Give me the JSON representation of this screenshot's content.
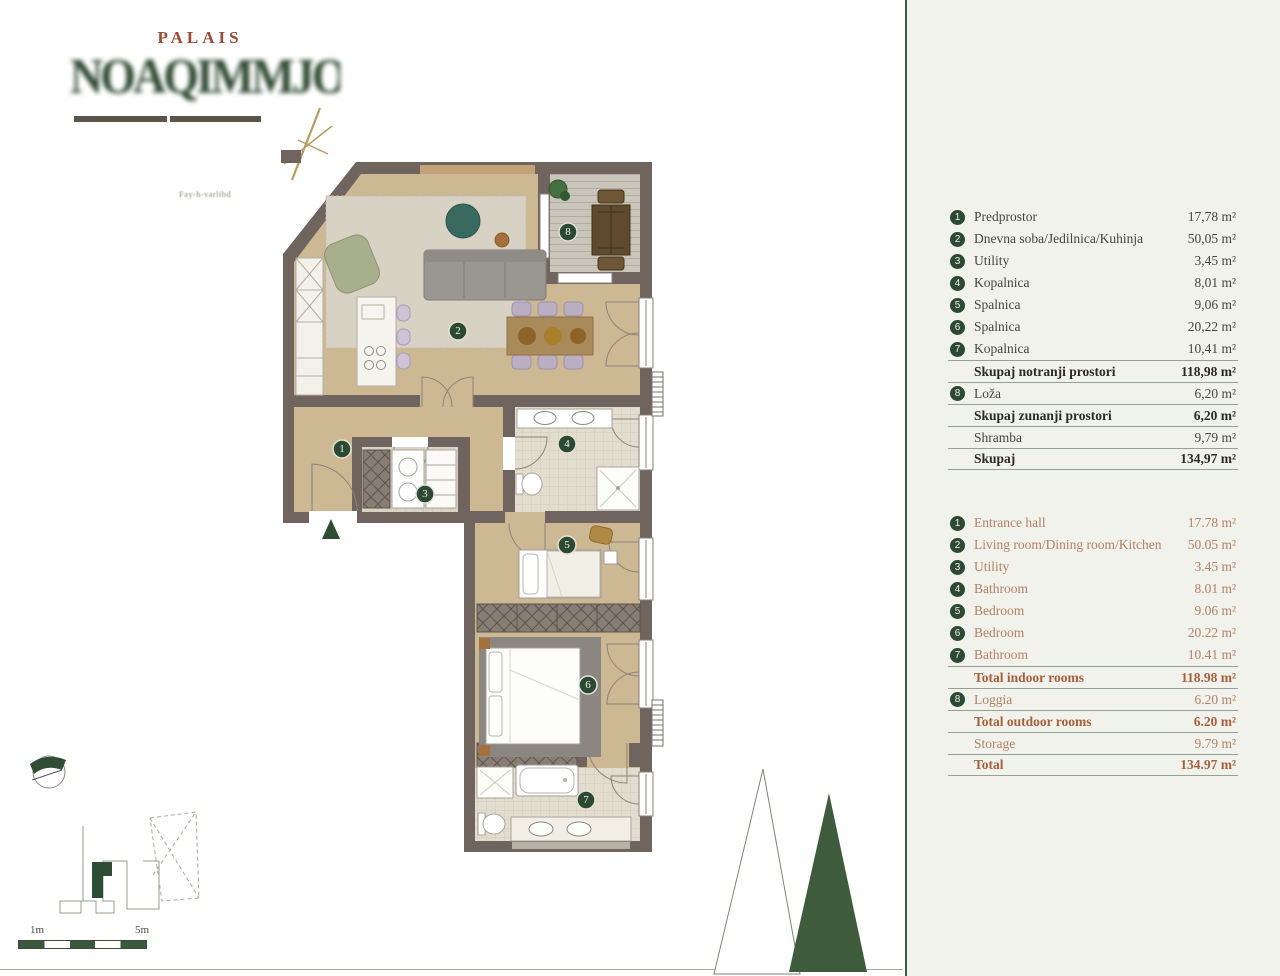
{
  "brand": {
    "title": "PALAIS",
    "logo_art_text": "NOAQIMMJOQRFI 4",
    "caption": "Fay-h-varlibd"
  },
  "legend_sl": {
    "rows": [
      {
        "n": "1",
        "label": "Predprostor",
        "value": "17,78 m²"
      },
      {
        "n": "2",
        "label": "Dnevna soba/Jedilnica/Kuhinja",
        "value": "50,05 m²"
      },
      {
        "n": "3",
        "label": "Utility",
        "value": "3,45 m²"
      },
      {
        "n": "4",
        "label": "Kopalnica",
        "value": "8,01 m²"
      },
      {
        "n": "5",
        "label": "Spalnica",
        "value": "9,06 m²"
      },
      {
        "n": "6",
        "label": "Spalnica",
        "value": "20,22 m²"
      },
      {
        "n": "7",
        "label": "Kopalnica",
        "value": "10,41 m²"
      },
      {
        "n": "",
        "label": "Skupaj notranji prostori",
        "value": "118,98 m²",
        "bold": true
      },
      {
        "n": "8",
        "label": "Loža",
        "value": "6,20 m²"
      },
      {
        "n": "",
        "label": "Skupaj zunanji prostori",
        "value": "6,20 m²",
        "bold": true
      },
      {
        "n": "",
        "label": "Shramba",
        "value": "9,79 m²"
      },
      {
        "n": "",
        "label": "Skupaj",
        "value": "134,97 m²",
        "bold": true
      }
    ]
  },
  "legend_en": {
    "rows": [
      {
        "n": "1",
        "label": "Entrance hall",
        "value": "17.78 m²"
      },
      {
        "n": "2",
        "label": "Living room/Dining room/Kitchen",
        "value": "50.05 m²"
      },
      {
        "n": "3",
        "label": "Utility",
        "value": "3.45 m²"
      },
      {
        "n": "4",
        "label": "Bathroom",
        "value": "8.01 m²"
      },
      {
        "n": "5",
        "label": "Bedroom",
        "value": "9.06 m²"
      },
      {
        "n": "6",
        "label": "Bedroom",
        "value": "20.22 m²"
      },
      {
        "n": "7",
        "label": "Bathroom",
        "value": "10.41 m²"
      },
      {
        "n": "",
        "label": "Total indoor rooms",
        "value": "118.98 m²",
        "bold": true
      },
      {
        "n": "8",
        "label": "Loggia",
        "value": "6.20 m²"
      },
      {
        "n": "",
        "label": "Total outdoor rooms",
        "value": "6.20 m²",
        "bold": true
      },
      {
        "n": "",
        "label": "Storage",
        "value": "9.79 m²"
      },
      {
        "n": "",
        "label": "Total",
        "value": "134.97 m²",
        "bold": true
      }
    ]
  },
  "plan": {
    "badges": [
      "1",
      "2",
      "3",
      "4",
      "5",
      "6",
      "7",
      "8"
    ]
  },
  "scalebar": {
    "left": "1m",
    "right": "5m"
  },
  "colors": {
    "accent_green": "#2c4a33",
    "accent_terracotta": "#a8603c",
    "panel_bg": "#f1f2eb",
    "wall": "#6f655e"
  }
}
